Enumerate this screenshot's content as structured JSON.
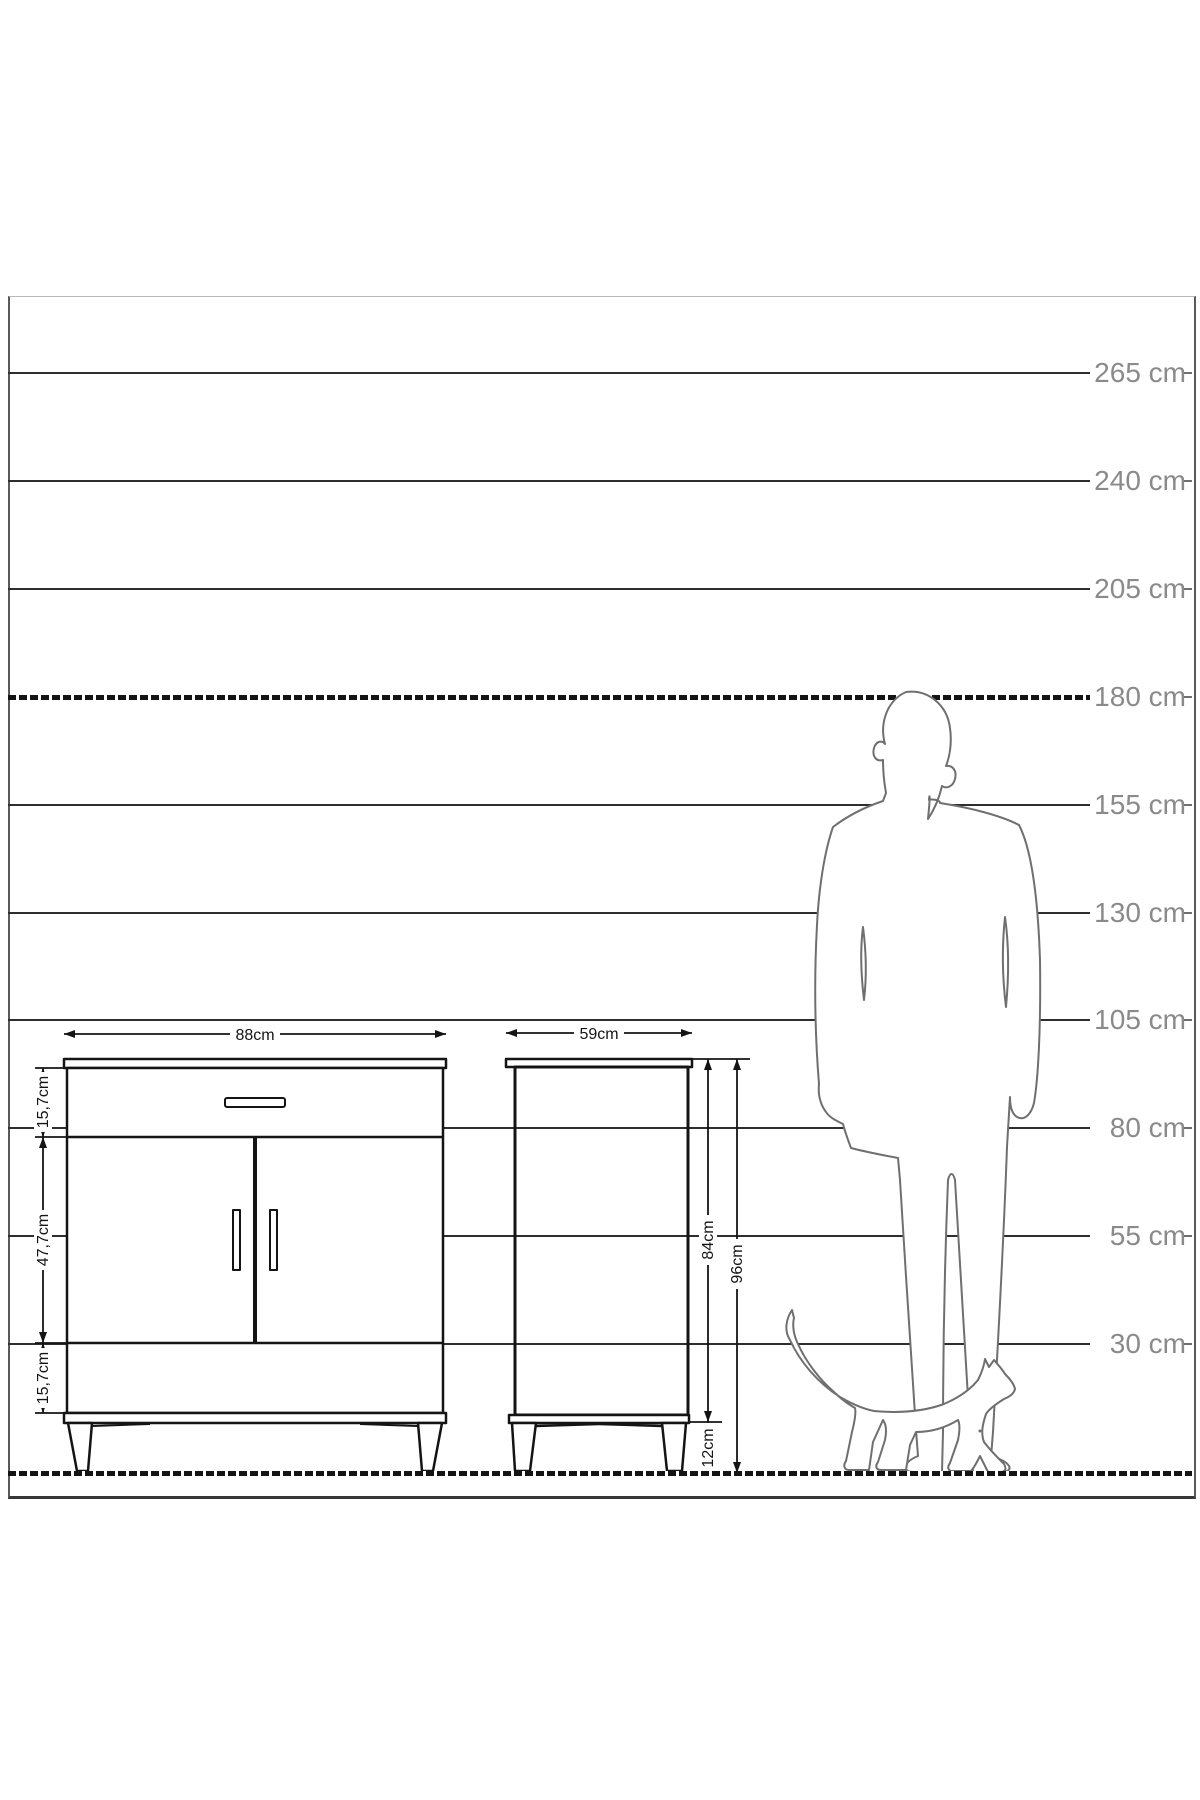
{
  "scale": {
    "unit": "cm",
    "marks": [
      {
        "label": "265 cm",
        "dashed": false
      },
      {
        "label": "240 cm",
        "dashed": false
      },
      {
        "label": "205 cm",
        "dashed": false
      },
      {
        "label": "180 cm",
        "dashed": true
      },
      {
        "label": "155 cm",
        "dashed": false
      },
      {
        "label": "130 cm",
        "dashed": false
      },
      {
        "label": "105 cm",
        "dashed": false
      },
      {
        "label": "80 cm",
        "dashed": false
      },
      {
        "label": "55 cm",
        "dashed": false
      },
      {
        "label": "30 cm",
        "dashed": false
      }
    ]
  },
  "front_view": {
    "width_label": "88cm",
    "top_drawer_height_label": "15,7cm",
    "door_height_label": "47,7cm",
    "bottom_drawer_height_label": "15,7cm"
  },
  "side_view": {
    "depth_label": "59cm",
    "carcass_height_label": "84cm",
    "total_height_label": "96cm",
    "leg_height_label": "12cm"
  },
  "colors": {
    "grid_line": "#2e2e2e",
    "scale_label": "#8a8a8a",
    "drawing_ink": "#141414",
    "silhouette_outline": "#6f6f6f",
    "background": "#ffffff"
  }
}
